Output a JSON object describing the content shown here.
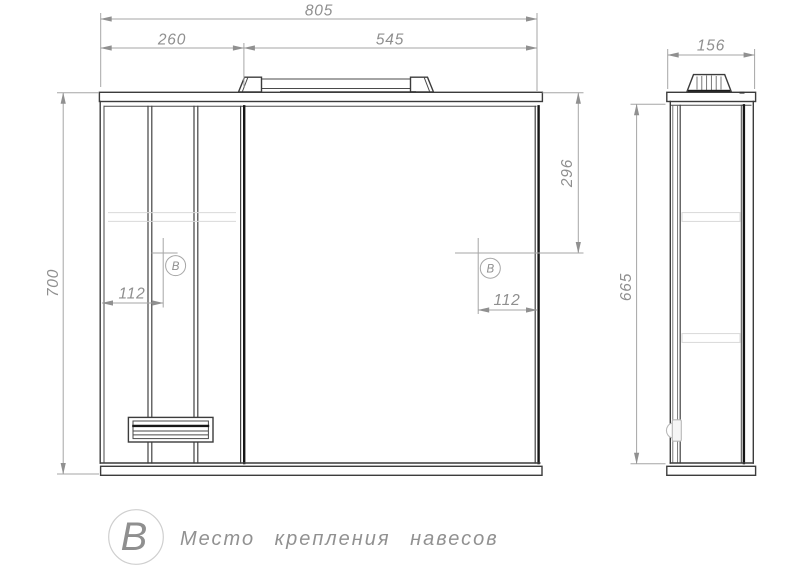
{
  "drawing": {
    "type": "furniture-technical-drawing",
    "front_view": {
      "total_width_mm": "805",
      "cabinet_width_mm": "260",
      "mirror_width_mm": "545",
      "total_height_mm": "700",
      "mount_top_offset_mm": "296",
      "mount_left_offset_mm": "112",
      "mount_right_offset_mm": "112"
    },
    "side_view": {
      "depth_mm": "156",
      "body_height_mm": "665"
    },
    "markers": {
      "mount_symbol": "В"
    },
    "legend": {
      "symbol": "В",
      "text": "Место крепления навесов"
    },
    "colors": {
      "outline": "#3c3c3c",
      "accent_dark": "#161616",
      "dimension": "#a6a6a6",
      "dim_text": "#8f8f8f",
      "background": "#ffffff"
    }
  }
}
